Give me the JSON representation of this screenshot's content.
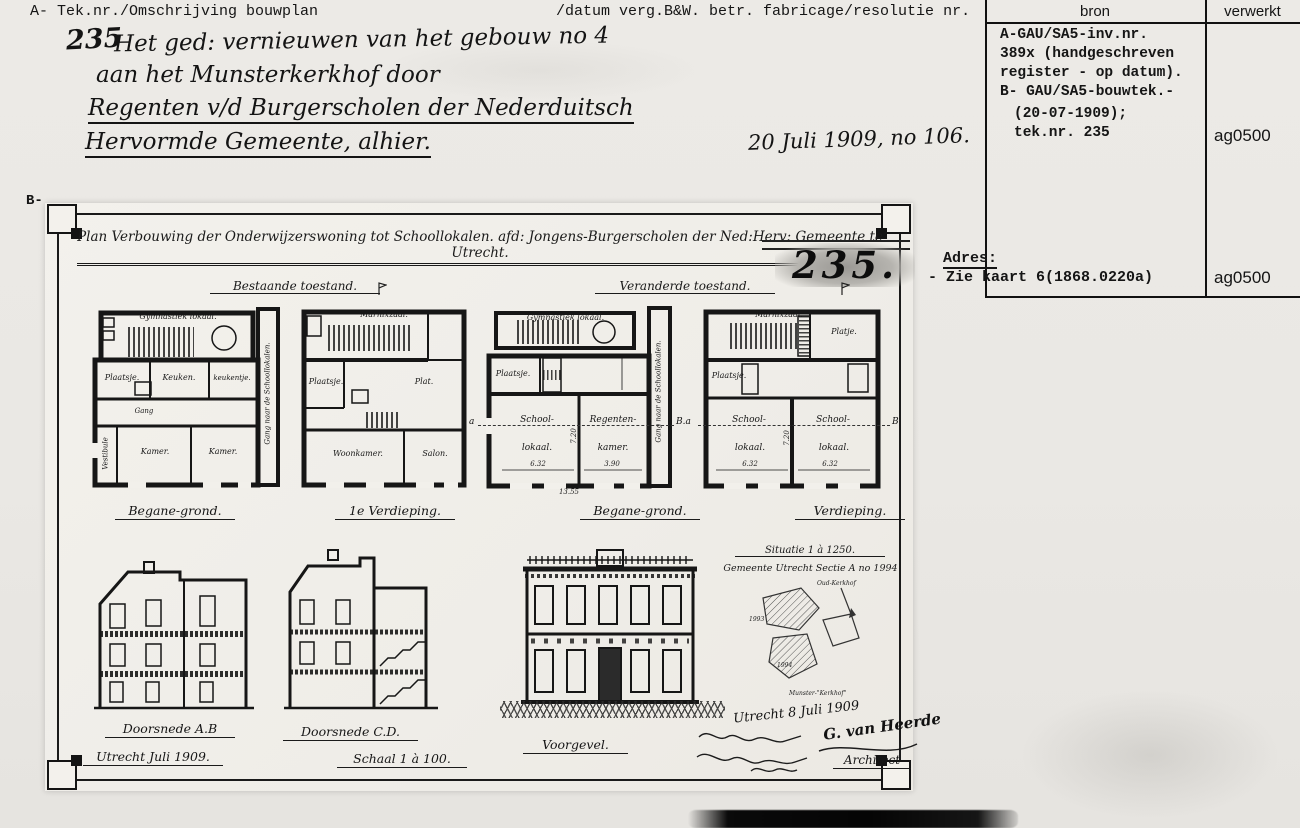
{
  "header": {
    "left_label": "A- Tek.nr./Omschrijving bouwplan",
    "middle_label": "/datum verg.B&W. betr. fabricage/resolutie nr.",
    "bron": "bron",
    "verwerkt": "verwerkt"
  },
  "source_panel": {
    "line1": "A-GAU/SA5-inv.nr.",
    "line2": "389x (handgeschreven",
    "line3": "register - op datum).",
    "line4": "B- GAU/SA5-bouwtek.-",
    "line5": "(20-07-1909);",
    "line6": "tek.nr. 235",
    "code_top": "ag0500",
    "code_bottom": "ag0500"
  },
  "handwritten": {
    "number": "235",
    "line1": "Het ged: vernieuwen van het gebouw no 4",
    "line2": "aan het Munsterkerkhof door",
    "line3": "Regenten v/d Burgerscholen der Nederduitsch",
    "line4": "Hervormde Gemeente, alhier.",
    "date_note": "20 Juli 1909, no 106."
  },
  "adres": {
    "label": "Adres:",
    "value": "- Zie kaart 6(1868.0220a)"
  },
  "sheet": {
    "b_label": "B-",
    "title": "Plan Verbouwing der Onderwijzerswoning tot Schoollokalen. afd: Jongens-Burgerscholen der Ned:Herv: Gemeente te Utrecht.",
    "stamp": "235.",
    "state_left": "Bestaande toestand.",
    "state_right": "Veranderde toestand.",
    "plans": [
      {
        "caption": "Begane-grond.",
        "rooms": {
          "gym": "Gymnastiek lokaal.",
          "plaatsje": "Plaatsje.",
          "keuken": "Keuken.",
          "keukentje": "keukentje.",
          "gang": "Gang",
          "vestibule": "Vestibule",
          "kamer1": "Kamer.",
          "kamer2": "Kamer.",
          "corridor": "Gang naar de Schoollokalen."
        }
      },
      {
        "caption": "1e Verdieping.",
        "rooms": {
          "zaal": "Marnixzaal.",
          "plaatsje": "Plaatsje.",
          "plat": "Plat.",
          "woonkamer": "Woonkamer.",
          "salon": "Salon."
        }
      },
      {
        "caption": "Begane-grond.",
        "rooms": {
          "gym": "Gymnastiek lokaal.",
          "plaatsje": "Plaatsje.",
          "school1a": "School-",
          "school1b": "lokaal.",
          "regenten1": "Regenten-",
          "regenten2": "kamer.",
          "corridor": "Gang naar de Schoollokalen."
        },
        "dims": {
          "w1": "6.32",
          "w2": "3.90",
          "h": "7.20",
          "total": "13.55"
        }
      },
      {
        "caption": "Verdieping.",
        "rooms": {
          "zaal": "Marnixzaal.",
          "platje": "Platje.",
          "plaatsje": "Plaatsje.",
          "school1a": "School-",
          "school1b": "lokaal.",
          "school2a": "School-",
          "school2b": "lokaal."
        },
        "dims": {
          "w1": "6.32",
          "w2": "6.32",
          "h": "7.20"
        }
      }
    ],
    "markers": {
      "a": "a",
      "ba": "B.a",
      "b": "B"
    },
    "bottom": {
      "doorsnede_ab": "Doorsnede A.B",
      "utrecht_date": "Utrecht Juli 1909.",
      "doorsnede_cd": "Doorsnede C.D.",
      "schaal": "Schaal 1 à 100.",
      "voorgevel": "Voorgevel.",
      "situatie1": "Situatie 1 à 1250.",
      "situatie2": "Gemeente Utrecht Sectie A no 1994",
      "situatie_top": "Oud-Kerkhof",
      "situatie_p1": "1993",
      "situatie_p2": "1994",
      "situatie_bottom": "Munster-\"Kerkhof\"",
      "sign_date": "Utrecht 8 Juli 1909",
      "sign_name": "G. van Heerde",
      "sign_role": "Architect"
    }
  }
}
